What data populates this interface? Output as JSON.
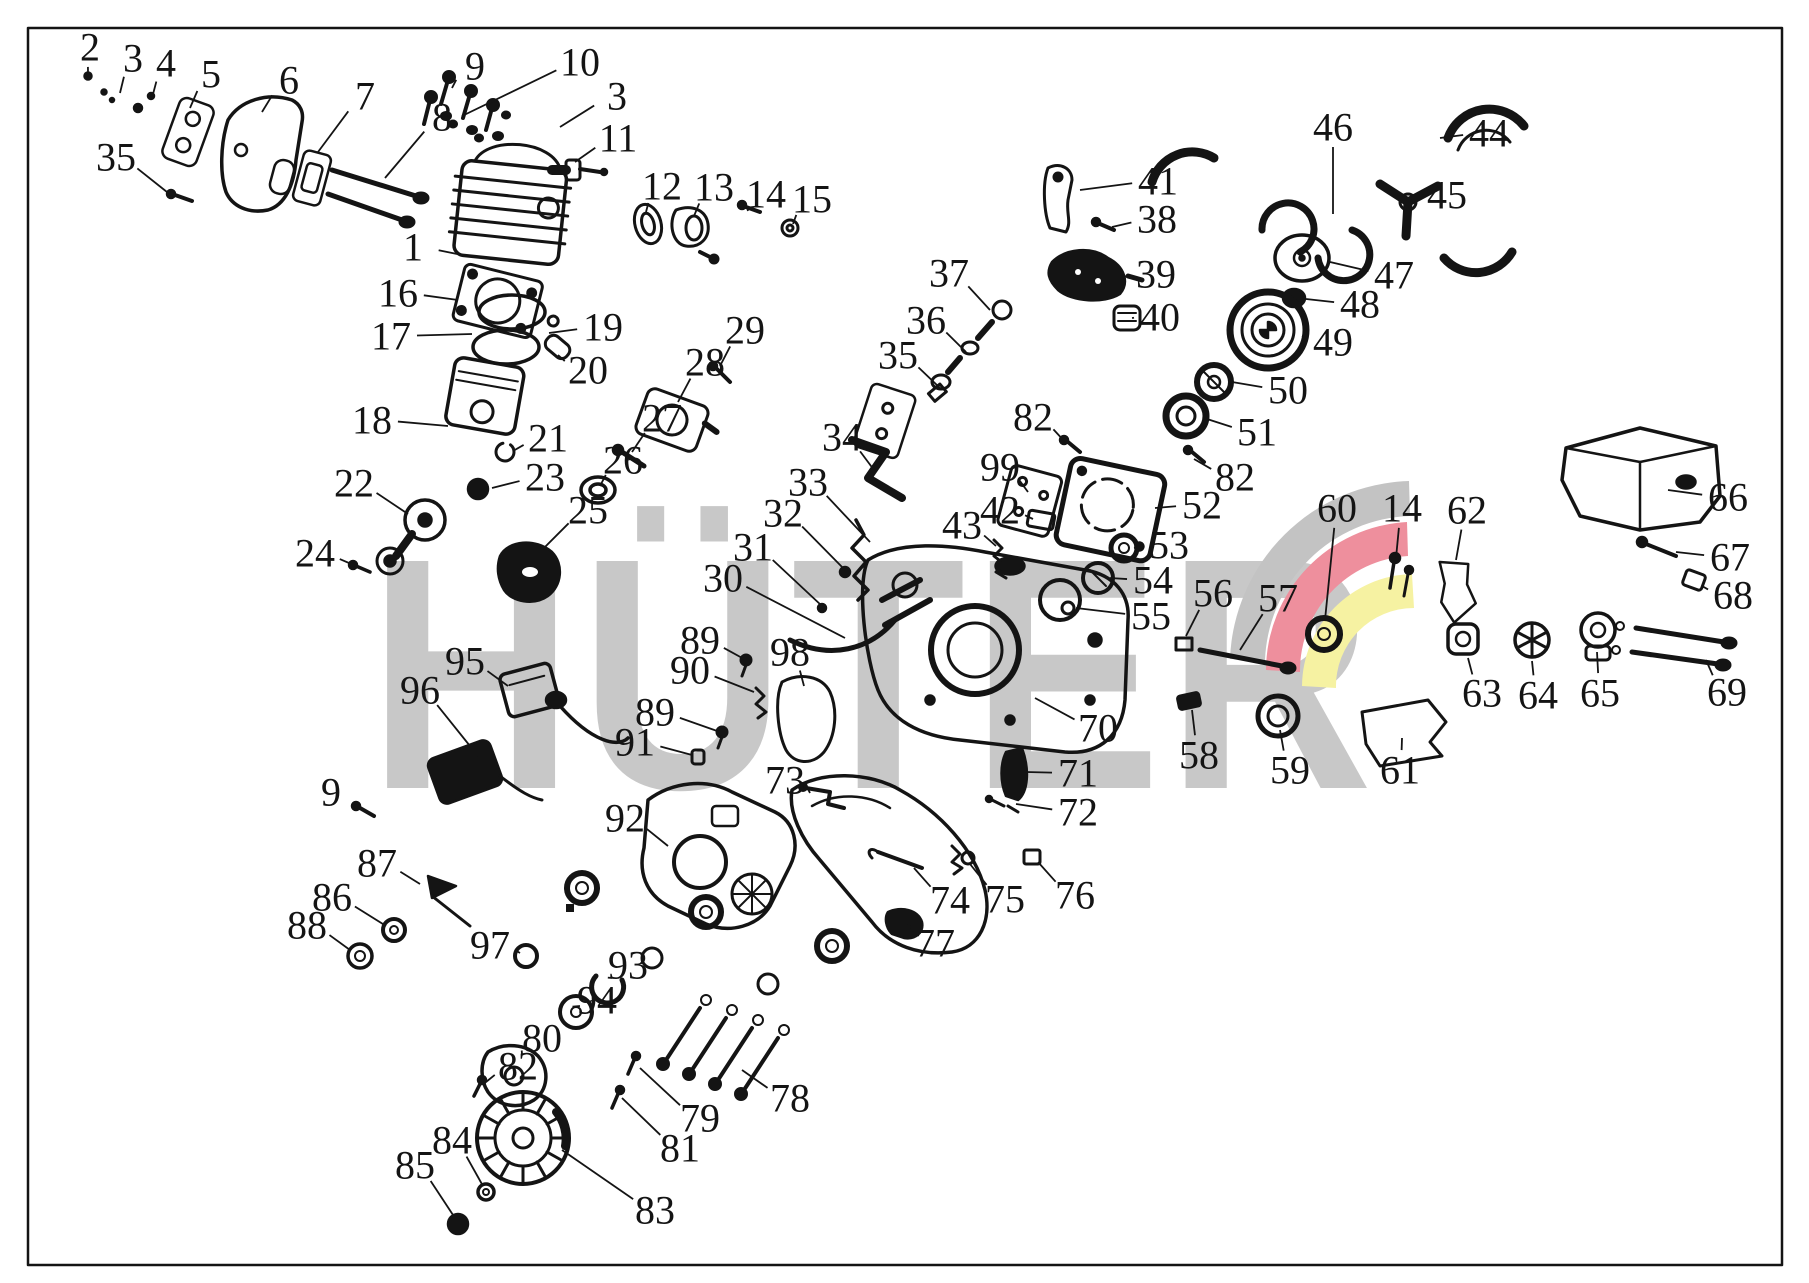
{
  "diagram": {
    "watermark": "HÜTER",
    "colors": {
      "line": "#141414",
      "watermark_gray": "#c8c8c8",
      "logo_gray": "#c3c3c3",
      "logo_red": "#ee8f9d",
      "logo_yellow": "#f6f2a2",
      "background": "#ffffff"
    },
    "callouts": [
      {
        "n": "2",
        "x": 90,
        "y": 47,
        "lx": 88,
        "ly": 72
      },
      {
        "n": "3",
        "x": 133,
        "y": 58,
        "lx": 120,
        "ly": 93
      },
      {
        "n": "4",
        "x": 166,
        "y": 63,
        "lx": 152,
        "ly": 98
      },
      {
        "n": "5",
        "x": 211,
        "y": 74,
        "lx": 190,
        "ly": 108
      },
      {
        "n": "6",
        "x": 289,
        "y": 80,
        "lx": 262,
        "ly": 112
      },
      {
        "n": "7",
        "x": 365,
        "y": 96,
        "lx": 318,
        "ly": 152
      },
      {
        "n": "8",
        "x": 442,
        "y": 117,
        "lx": 385,
        "ly": 178
      },
      {
        "n": "9",
        "x": 475,
        "y": 66,
        "lx": 452,
        "ly": 88
      },
      {
        "n": "10",
        "x": 580,
        "y": 62,
        "lx": 462,
        "ly": 116
      },
      {
        "n": "3",
        "x": 617,
        "y": 96,
        "lx": 560,
        "ly": 127
      },
      {
        "n": "11",
        "x": 618,
        "y": 138,
        "lx": 575,
        "ly": 162
      },
      {
        "n": "12",
        "x": 662,
        "y": 186,
        "lx": 646,
        "ly": 212
      },
      {
        "n": "13",
        "x": 714,
        "y": 187,
        "lx": 694,
        "ly": 216
      },
      {
        "n": "14",
        "x": 766,
        "y": 194,
        "lx": 748,
        "ly": 211
      },
      {
        "n": "15",
        "x": 812,
        "y": 199,
        "lx": 793,
        "ly": 224
      },
      {
        "n": "1",
        "x": 413,
        "y": 247,
        "lx": 462,
        "ly": 255
      },
      {
        "n": "16",
        "x": 398,
        "y": 293,
        "lx": 458,
        "ly": 300
      },
      {
        "n": "17",
        "x": 391,
        "y": 336,
        "lx": 472,
        "ly": 334
      },
      {
        "n": "18",
        "x": 372,
        "y": 420,
        "lx": 448,
        "ly": 426
      },
      {
        "n": "19",
        "x": 603,
        "y": 327,
        "lx": 549,
        "ly": 333
      },
      {
        "n": "20",
        "x": 588,
        "y": 370,
        "lx": 558,
        "ly": 355
      },
      {
        "n": "21",
        "x": 548,
        "y": 438,
        "lx": 513,
        "ly": 451
      },
      {
        "n": "23",
        "x": 545,
        "y": 477,
        "lx": 492,
        "ly": 488
      },
      {
        "n": "22",
        "x": 354,
        "y": 483,
        "lx": 408,
        "ly": 514
      },
      {
        "n": "24",
        "x": 315,
        "y": 553,
        "lx": 356,
        "ly": 566
      },
      {
        "n": "25",
        "x": 588,
        "y": 510,
        "lx": 532,
        "ly": 560
      },
      {
        "n": "26",
        "x": 623,
        "y": 460,
        "lx": 600,
        "ly": 486
      },
      {
        "n": "27",
        "x": 662,
        "y": 418,
        "lx": 632,
        "ly": 452
      },
      {
        "n": "28",
        "x": 705,
        "y": 362,
        "lx": 678,
        "ly": 402
      },
      {
        "n": "29",
        "x": 745,
        "y": 330,
        "lx": 720,
        "ly": 366
      },
      {
        "n": "30",
        "x": 723,
        "y": 578,
        "lx": 845,
        "ly": 638
      },
      {
        "n": "31",
        "x": 753,
        "y": 547,
        "lx": 822,
        "ly": 606
      },
      {
        "n": "32",
        "x": 783,
        "y": 513,
        "lx": 845,
        "ly": 570
      },
      {
        "n": "33",
        "x": 808,
        "y": 482,
        "lx": 870,
        "ly": 542
      },
      {
        "n": "34",
        "x": 842,
        "y": 437,
        "lx": 874,
        "ly": 470
      },
      {
        "n": "37",
        "x": 949,
        "y": 273,
        "lx": 990,
        "ly": 310
      },
      {
        "n": "36",
        "x": 926,
        "y": 320,
        "lx": 966,
        "ly": 352
      },
      {
        "n": "35",
        "x": 898,
        "y": 355,
        "lx": 940,
        "ly": 388
      },
      {
        "n": "35",
        "x": 116,
        "y": 157,
        "lx": 172,
        "ly": 196
      },
      {
        "n": "41",
        "x": 1158,
        "y": 181,
        "lx": 1080,
        "ly": 190
      },
      {
        "n": "38",
        "x": 1157,
        "y": 219,
        "lx": 1112,
        "ly": 227
      },
      {
        "n": "39",
        "x": 1156,
        "y": 274,
        "lx": 1122,
        "ly": 277
      },
      {
        "n": "40",
        "x": 1160,
        "y": 317,
        "lx": 1132,
        "ly": 318
      },
      {
        "n": "46",
        "x": 1333,
        "y": 127,
        "lx": 1333,
        "ly": 214
      },
      {
        "n": "44",
        "x": 1489,
        "y": 133,
        "lx": 1440,
        "ly": 138
      },
      {
        "n": "45",
        "x": 1447,
        "y": 195,
        "lx": 1400,
        "ly": 200
      },
      {
        "n": "47",
        "x": 1394,
        "y": 275,
        "lx": 1330,
        "ly": 262
      },
      {
        "n": "48",
        "x": 1360,
        "y": 304,
        "lx": 1306,
        "ly": 299
      },
      {
        "n": "49",
        "x": 1333,
        "y": 342,
        "lx": 1302,
        "ly": 336
      },
      {
        "n": "50",
        "x": 1288,
        "y": 390,
        "lx": 1232,
        "ly": 382
      },
      {
        "n": "51",
        "x": 1257,
        "y": 432,
        "lx": 1207,
        "ly": 419
      },
      {
        "n": "82",
        "x": 1033,
        "y": 417,
        "lx": 1066,
        "ly": 443
      },
      {
        "n": "99",
        "x": 1000,
        "y": 467,
        "lx": 1028,
        "ly": 492
      },
      {
        "n": "42",
        "x": 1000,
        "y": 510,
        "lx": 1033,
        "ly": 519
      },
      {
        "n": "43",
        "x": 962,
        "y": 525,
        "lx": 996,
        "ly": 546
      },
      {
        "n": "82",
        "x": 1235,
        "y": 477,
        "lx": 1194,
        "ly": 459
      },
      {
        "n": "52",
        "x": 1202,
        "y": 505,
        "lx": 1155,
        "ly": 508
      },
      {
        "n": "53",
        "x": 1169,
        "y": 545,
        "lx": 1134,
        "ly": 548
      },
      {
        "n": "54",
        "x": 1153,
        "y": 580,
        "lx": 1110,
        "ly": 578
      },
      {
        "n": "55",
        "x": 1151,
        "y": 616,
        "lx": 1076,
        "ly": 608
      },
      {
        "n": "56",
        "x": 1213,
        "y": 593,
        "lx": 1186,
        "ly": 636
      },
      {
        "n": "57",
        "x": 1278,
        "y": 598,
        "lx": 1240,
        "ly": 650
      },
      {
        "n": "60",
        "x": 1337,
        "y": 508,
        "lx": 1325,
        "ly": 620
      },
      {
        "n": "14",
        "x": 1402,
        "y": 508,
        "lx": 1396,
        "ly": 558
      },
      {
        "n": "62",
        "x": 1467,
        "y": 510,
        "lx": 1456,
        "ly": 560
      },
      {
        "n": "66",
        "x": 1728,
        "y": 497,
        "lx": 1668,
        "ly": 490
      },
      {
        "n": "67",
        "x": 1730,
        "y": 557,
        "lx": 1676,
        "ly": 552
      },
      {
        "n": "68",
        "x": 1733,
        "y": 595,
        "lx": 1702,
        "ly": 586
      },
      {
        "n": "63",
        "x": 1482,
        "y": 693,
        "lx": 1468,
        "ly": 658
      },
      {
        "n": "64",
        "x": 1538,
        "y": 695,
        "lx": 1532,
        "ly": 661
      },
      {
        "n": "65",
        "x": 1600,
        "y": 693,
        "lx": 1597,
        "ly": 652
      },
      {
        "n": "69",
        "x": 1727,
        "y": 692,
        "lx": 1706,
        "ly": 660
      },
      {
        "n": "61",
        "x": 1400,
        "y": 770,
        "lx": 1402,
        "ly": 738
      },
      {
        "n": "58",
        "x": 1199,
        "y": 755,
        "lx": 1192,
        "ly": 710
      },
      {
        "n": "59",
        "x": 1290,
        "y": 770,
        "lx": 1280,
        "ly": 730
      },
      {
        "n": "70",
        "x": 1098,
        "y": 728,
        "lx": 1035,
        "ly": 698
      },
      {
        "n": "71",
        "x": 1078,
        "y": 773,
        "lx": 1026,
        "ly": 772
      },
      {
        "n": "72",
        "x": 1078,
        "y": 812,
        "lx": 1016,
        "ly": 804
      },
      {
        "n": "73",
        "x": 785,
        "y": 780,
        "lx": 810,
        "ly": 793
      },
      {
        "n": "89",
        "x": 700,
        "y": 640,
        "lx": 744,
        "ly": 659
      },
      {
        "n": "90",
        "x": 690,
        "y": 670,
        "lx": 754,
        "ly": 692
      },
      {
        "n": "89",
        "x": 655,
        "y": 712,
        "lx": 720,
        "ly": 732
      },
      {
        "n": "91",
        "x": 635,
        "y": 742,
        "lx": 692,
        "ly": 755
      },
      {
        "n": "98",
        "x": 790,
        "y": 652,
        "lx": 804,
        "ly": 686
      },
      {
        "n": "95",
        "x": 465,
        "y": 661,
        "lx": 508,
        "ly": 686
      },
      {
        "n": "96",
        "x": 420,
        "y": 690,
        "lx": 478,
        "ly": 756
      },
      {
        "n": "9",
        "x": 331,
        "y": 792,
        "lx": 357,
        "ly": 809
      },
      {
        "n": "92",
        "x": 625,
        "y": 818,
        "lx": 668,
        "ly": 846
      },
      {
        "n": "87",
        "x": 377,
        "y": 863,
        "lx": 420,
        "ly": 884
      },
      {
        "n": "86",
        "x": 332,
        "y": 897,
        "lx": 386,
        "ly": 926
      },
      {
        "n": "88",
        "x": 307,
        "y": 925,
        "lx": 350,
        "ly": 950
      },
      {
        "n": "97",
        "x": 490,
        "y": 945,
        "lx": 520,
        "ly": 953
      },
      {
        "n": "93",
        "x": 628,
        "y": 965,
        "lx": 612,
        "ly": 978
      },
      {
        "n": "94",
        "x": 597,
        "y": 1000,
        "lx": 580,
        "ly": 1006
      },
      {
        "n": "80",
        "x": 542,
        "y": 1038,
        "lx": 522,
        "ly": 1054
      },
      {
        "n": "82",
        "x": 518,
        "y": 1066,
        "lx": 486,
        "ly": 1082
      },
      {
        "n": "78",
        "x": 790,
        "y": 1098,
        "lx": 742,
        "ly": 1070
      },
      {
        "n": "79",
        "x": 700,
        "y": 1118,
        "lx": 640,
        "ly": 1068
      },
      {
        "n": "81",
        "x": 680,
        "y": 1148,
        "lx": 622,
        "ly": 1098
      },
      {
        "n": "84",
        "x": 452,
        "y": 1140,
        "lx": 483,
        "ly": 1186
      },
      {
        "n": "85",
        "x": 415,
        "y": 1165,
        "lx": 455,
        "ly": 1218
      },
      {
        "n": "83",
        "x": 655,
        "y": 1210,
        "lx": 562,
        "ly": 1150
      },
      {
        "n": "74",
        "x": 950,
        "y": 900,
        "lx": 914,
        "ly": 868
      },
      {
        "n": "75",
        "x": 1005,
        "y": 899,
        "lx": 970,
        "ly": 864
      },
      {
        "n": "76",
        "x": 1075,
        "y": 895,
        "lx": 1038,
        "ly": 862
      },
      {
        "n": "77",
        "x": 935,
        "y": 943,
        "lx": 908,
        "ly": 924
      }
    ]
  }
}
